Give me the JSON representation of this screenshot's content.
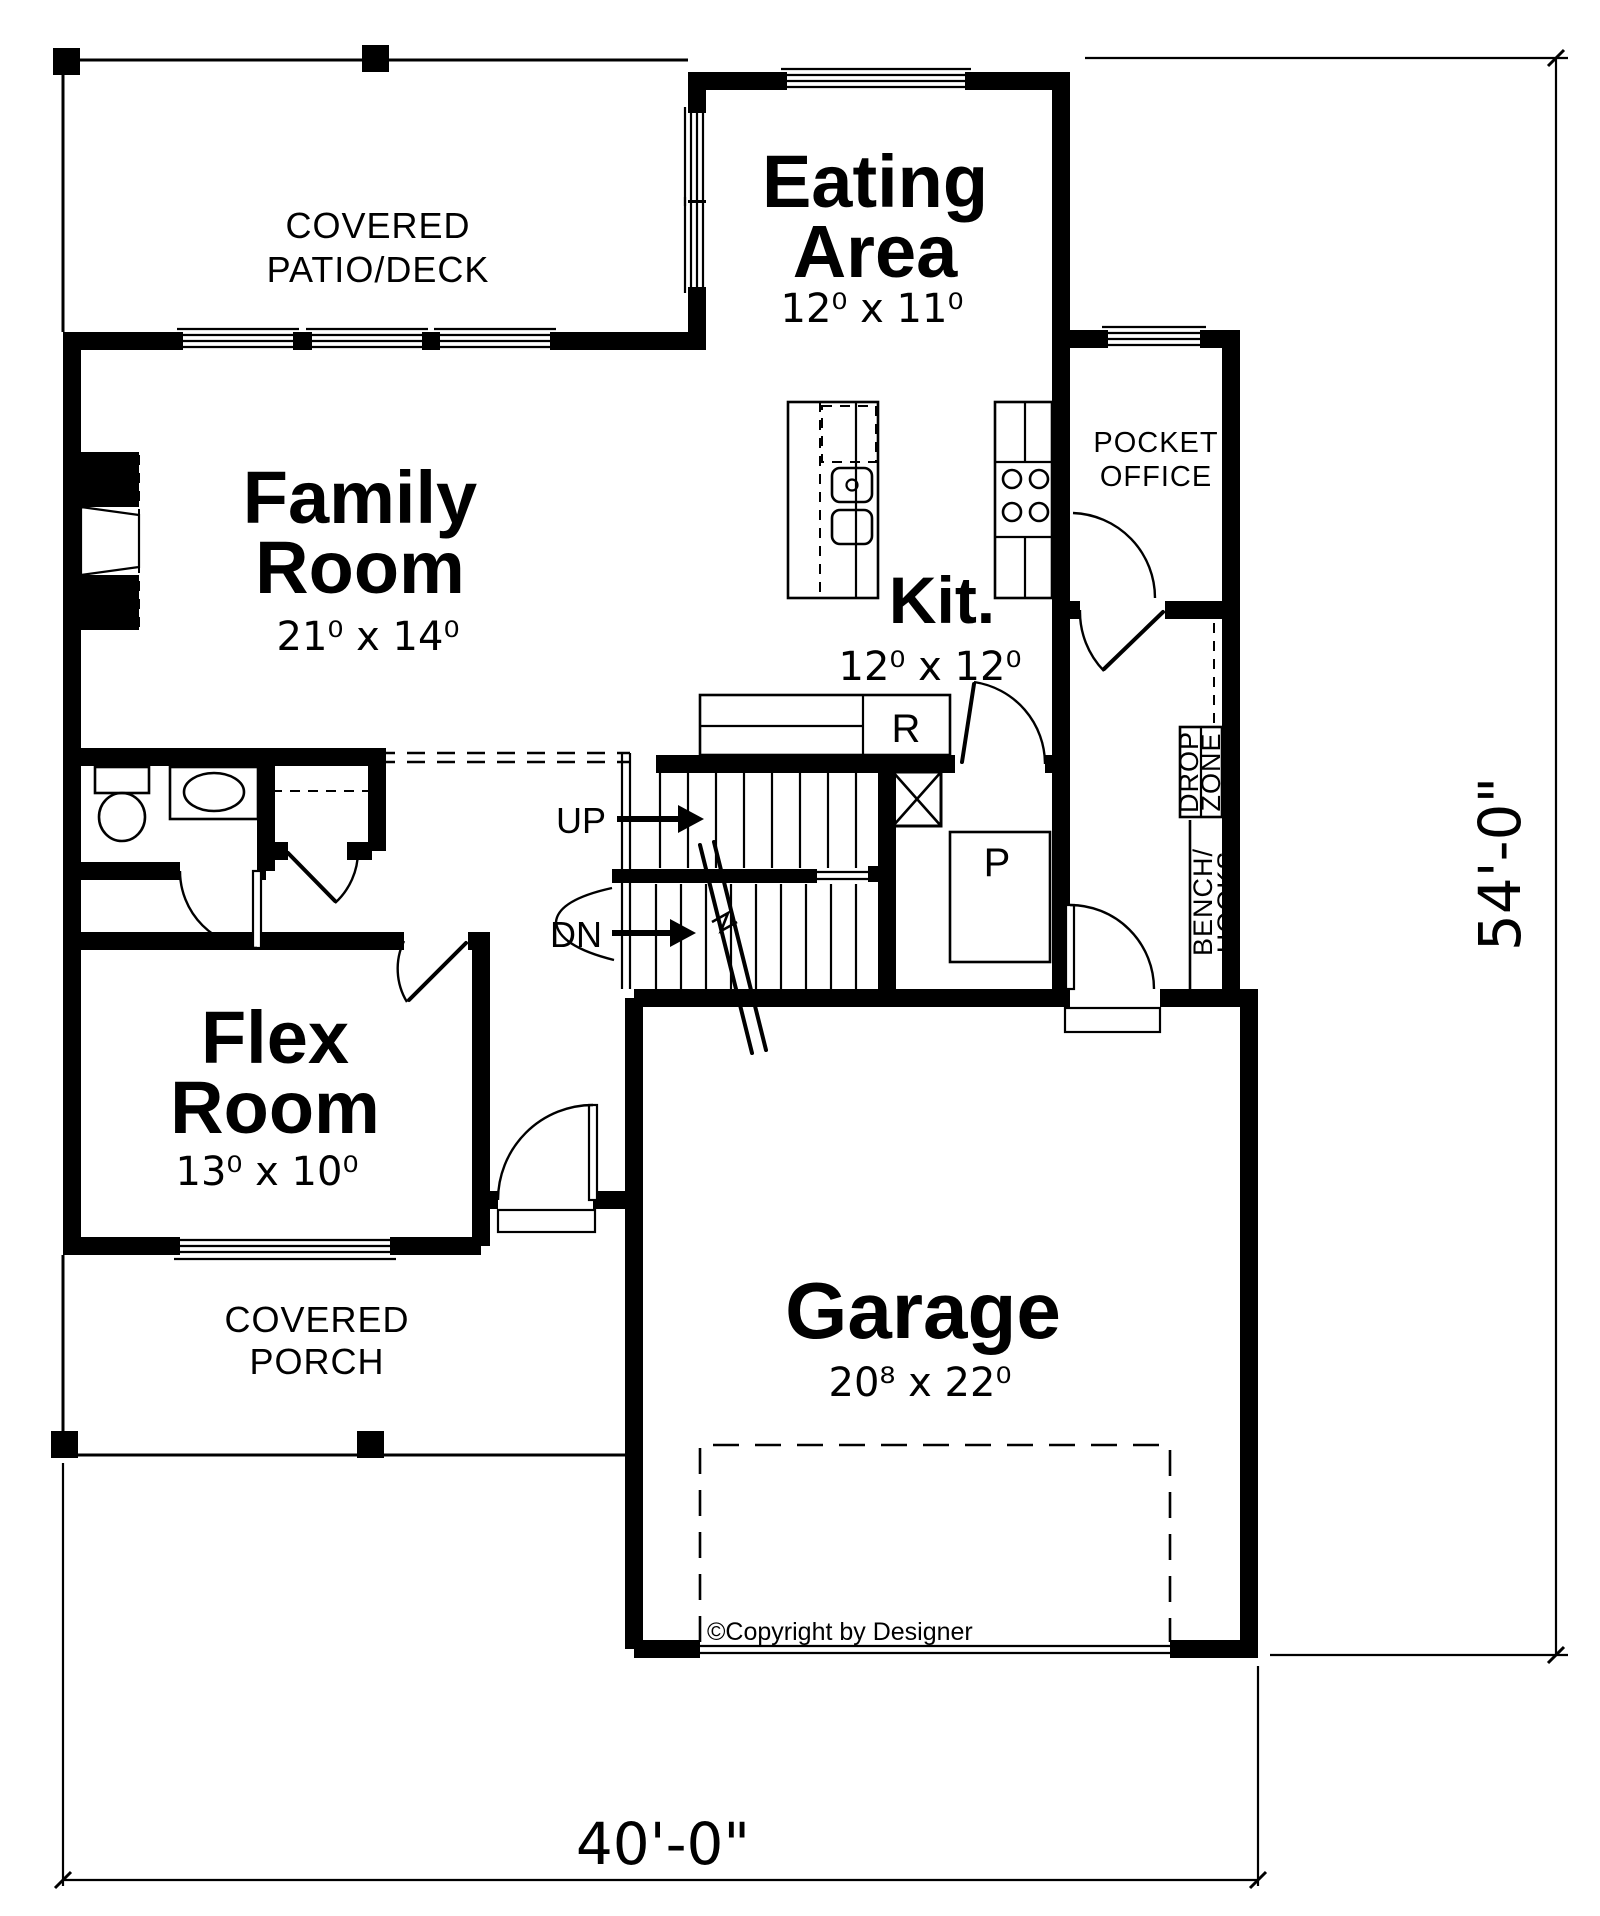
{
  "rooms": {
    "covered_patio": {
      "line1": "COVERED",
      "line2": "PATIO/DECK"
    },
    "eating_area": {
      "line1": "Eating",
      "line2": "Area",
      "dims": "12⁰ x 11⁰"
    },
    "family_room": {
      "line1": "Family",
      "line2": "Room",
      "dims": "21⁰ x 14⁰"
    },
    "pocket_office": {
      "line1": "POCKET",
      "line2": "OFFICE"
    },
    "kitchen": {
      "name": "Kit.",
      "dims": "12⁰ x 12⁰"
    },
    "flex_room": {
      "line1": "Flex",
      "line2": "Room",
      "dims": "13⁰ x 10⁰"
    },
    "covered_porch": {
      "line1": "COVERED",
      "line2": "PORCH"
    },
    "garage": {
      "name": "Garage",
      "dims": "20⁸ x 22⁰"
    }
  },
  "labels": {
    "up": "UP",
    "down": "DN",
    "refrigerator": "R",
    "pantry": "P",
    "drop_zone": {
      "line1": "DROP",
      "line2": "ZONE"
    },
    "bench_hooks": {
      "line1": "BENCH/",
      "line2": "HOOKS"
    }
  },
  "dimensions": {
    "overall_width": "40'-0\"",
    "overall_depth": "54'-0\""
  },
  "copyright": "©Copyright by Designer",
  "colors": {
    "ink": "#000000",
    "paper": "#ffffff"
  }
}
